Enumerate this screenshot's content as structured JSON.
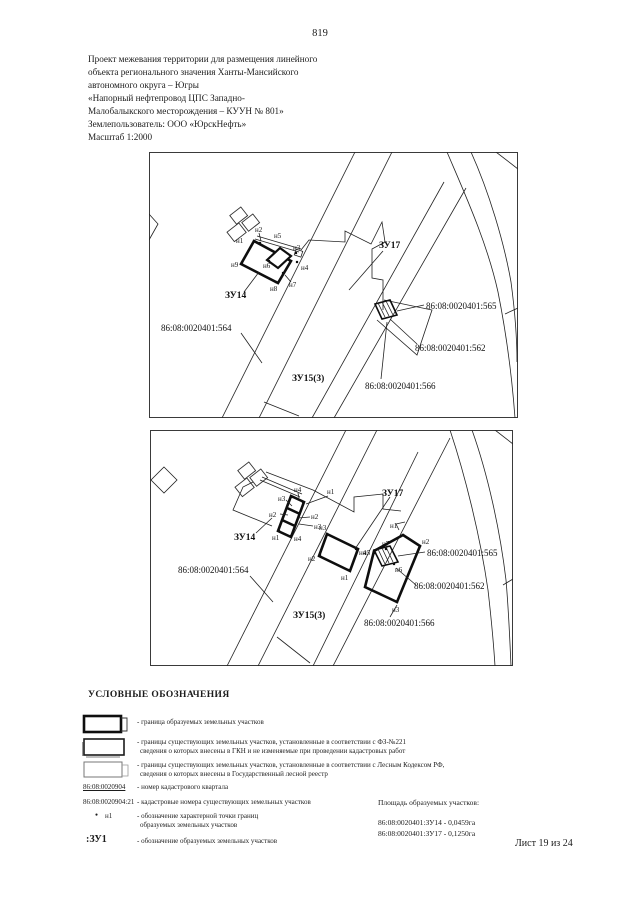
{
  "page": {
    "number": "819",
    "sheet_label": "Лист 19 из 24"
  },
  "header": {
    "lines": [
      "Проект межевания территории для размещения линейного",
      "объекта регионального значения Ханты-Мансийского",
      "автономного округа – Югры",
      "«Напорный нефтепровод ЦПС Западно-",
      "Малобалыкского месторождения – КУУН № 801»",
      "Землепользователь: ООО «ЮрскНефть»",
      "Масштаб 1:2000"
    ]
  },
  "map_labels": {
    "zu14": "ЗУ14",
    "zu17": "ЗУ17",
    "zu15": "ЗУ15(3)",
    "c564": "86:08:0020401:564",
    "c565": "86:08:0020401:565",
    "c562": "86:08:0020401:562",
    "c566": "86:08:0020401:566"
  },
  "points": {
    "n1": "н1",
    "n2": "н2",
    "n3": "н3",
    "n4": "н4",
    "n5": "н5",
    "n6": "н6",
    "n7": "н7",
    "n8": "н8",
    "n9": "н9"
  },
  "legend": {
    "title": "УСЛОВНЫЕ ОБОЗНАЧЕНИЯ",
    "item1": "- граница образуемых земельных участков",
    "item2_line1": "- границы существующих земельных участков, установленные в соответствии с ФЗ-№221",
    "item2_line2": "сведения о которых внесены в ГКН и не изменяемые при проведении кадастровых работ",
    "item3_line1": "- границы существующих земельных участков, установленные в соответствии с Лесным Кодексом РФ,",
    "item3_line2": "сведения о которых внесены в Государственный лесной реестр",
    "kvartal_code": "86:08:0020904",
    "kvartal_desc": "- номер кадастрового квартала",
    "existing_code": "86:08:0020904:21",
    "existing_desc": "- кадастровые номера существующих земельных участков",
    "point_symbol": "●",
    "point_code": "н1",
    "point_desc1": "- обозначение характерной точки границ",
    "point_desc2": "образуемых земельных участков",
    "zu_code": ":ЗУ1",
    "zu_desc": "- обозначение образуемых земельных участков"
  },
  "areas": {
    "title": "Площадь образуемых участков:",
    "line1": "86:08:0020401:ЗУ14  - 0,0459га",
    "line2": "86:08:0020401:ЗУ17  - 0,1250га"
  }
}
